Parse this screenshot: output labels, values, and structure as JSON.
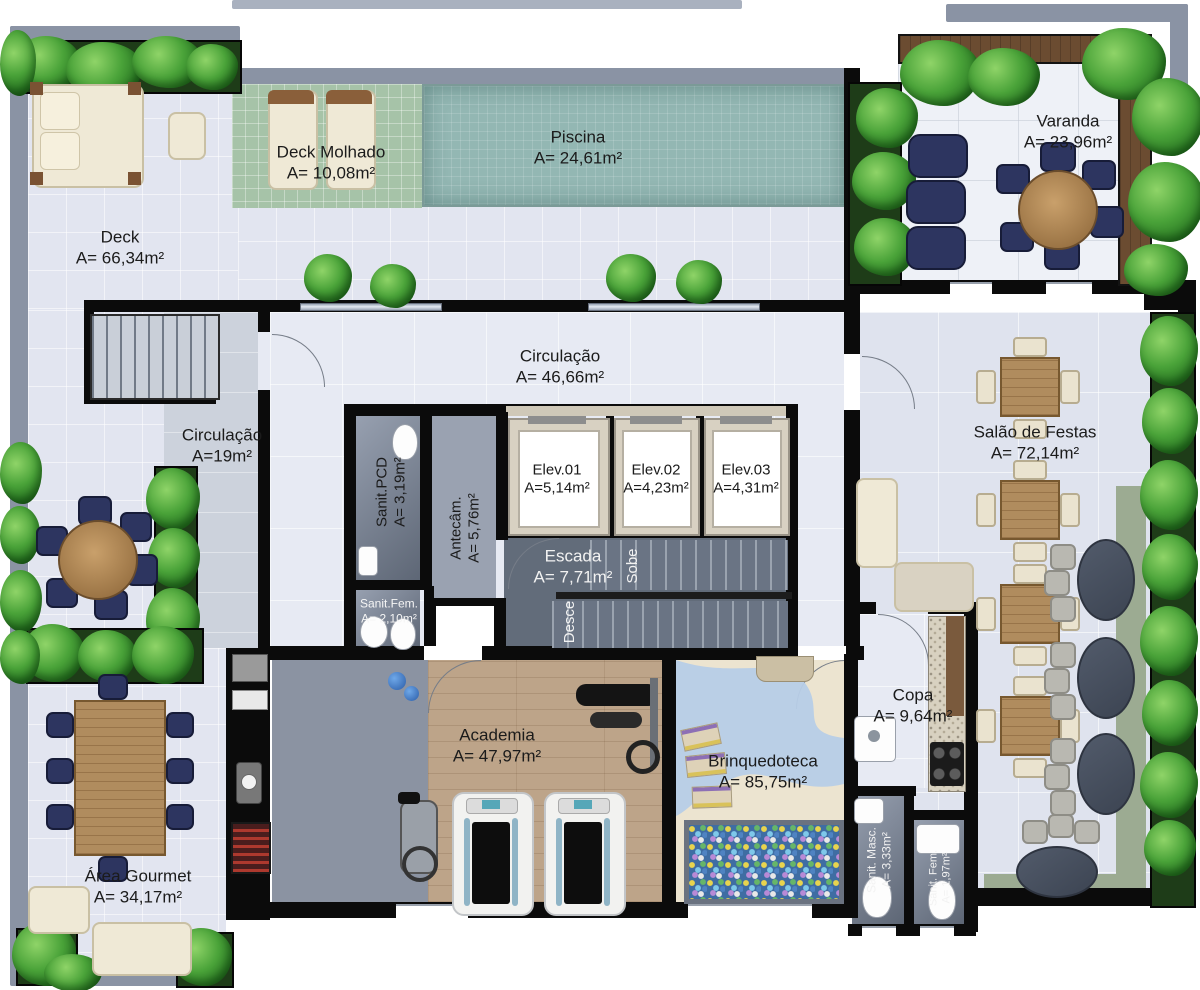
{
  "rooms": {
    "deck": {
      "name": "Deck",
      "area": "A= 66,34m²"
    },
    "deck_molhado": {
      "name": "Deck Molhado",
      "area": "A= 10,08m²"
    },
    "piscina": {
      "name": "Piscina",
      "area": "A= 24,61m²"
    },
    "varanda": {
      "name": "Varanda",
      "area": "A= 23,96m²"
    },
    "circulacao_hall": {
      "name": "Circulação",
      "area": "A= 46,66m²"
    },
    "circulacao_corr": {
      "name": "Circulação",
      "area": "A=19m²"
    },
    "sanit_pcd": {
      "name": "Sanit.PCD",
      "area": "A= 3,19m²"
    },
    "antecam": {
      "name": "Antecâm.",
      "area": "A= 5,76m²"
    },
    "elev1": {
      "name": "Elev.01",
      "area": "A=5,14m²"
    },
    "elev2": {
      "name": "Elev.02",
      "area": "A=4,23m²"
    },
    "elev3": {
      "name": "Elev.03",
      "area": "A=4,31m²"
    },
    "escada": {
      "name": "Escada",
      "area": "A= 7,71m²"
    },
    "salao": {
      "name": "Salão de Festas",
      "area": "A= 72,14m²"
    },
    "sanit_fem_core": {
      "name": "Sanit.Fem.",
      "area": "A= 2,10m²"
    },
    "academia": {
      "name": "Academia",
      "area": "A= 47,97m²"
    },
    "brinquedoteca": {
      "name": "Brinquedoteca",
      "area": "A= 85,75m²"
    },
    "copa": {
      "name": "Copa",
      "area": "A= 9,64m²"
    },
    "sanit_masc": {
      "name": "Sanit. Masc.",
      "area": "A= 3,33m²"
    },
    "sanit_fem_small": {
      "name": "Sanit. Fem.",
      "area": "A= 1,97m²"
    },
    "area_gourmet": {
      "name": "Área Gourmet",
      "area": "A= 34,17m²"
    }
  },
  "stairs": {
    "up": "Sobe",
    "down": "Desce"
  },
  "colors": {
    "wall": "#0b0b0b",
    "parapet": "#8a93a4",
    "deck_floor": "#e2e5f0",
    "pool_water": "#93b7b3",
    "wet_deck_tile": "#a6c3a8",
    "indoor_tile": "#e7eaf3",
    "corridor_floor": "#ccd2dc",
    "bath_floor": "#79818f",
    "gym_floor": "#8b93a2",
    "wood": "#b08c5e",
    "playroom_floor": "#ece4d0",
    "river": "#b7cde7",
    "sage_band": "#9cab92",
    "plant_green": "#3f9b34",
    "navy_chair": "#2d3560",
    "cream": "#efe9d6",
    "marble_table": "#47505f"
  }
}
